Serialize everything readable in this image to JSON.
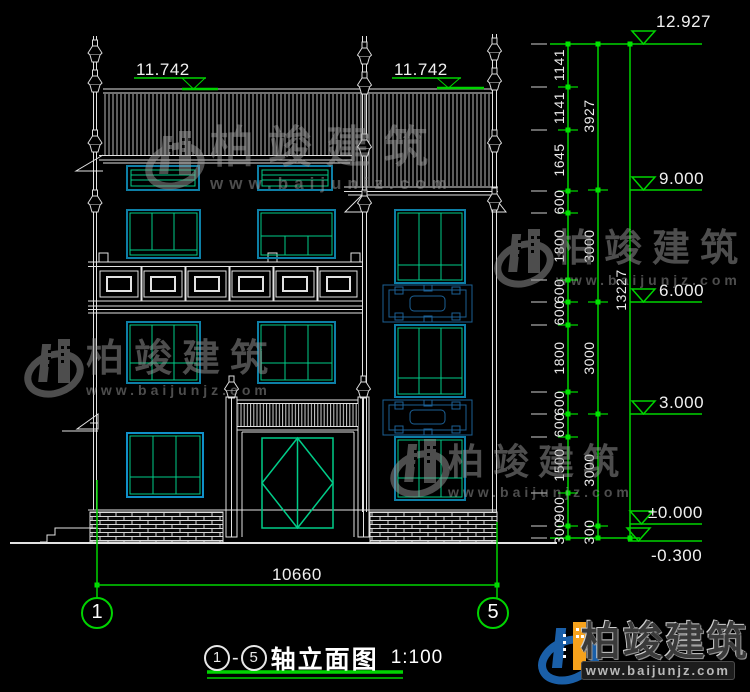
{
  "drawing_type": "elevation",
  "colors": {
    "background": "#000000",
    "linework_white": "#e2e2e2",
    "dimension_green": "#00d400",
    "window_frame_cyan": "#0d7fa6",
    "window_glass_green": "#00cc88",
    "panel_blue": "#1c6095",
    "logo_blue": "#1a5fa8",
    "logo_orange": "#f6a21c"
  },
  "annotations": {
    "eave_levels": [
      "11.742",
      "11.742"
    ],
    "levels": [
      "12.927",
      "9.000",
      "6.000",
      "3.000",
      "±0.000",
      "-0.300"
    ],
    "dim_chain_inner": [
      "1141",
      "1141",
      "1645",
      "600",
      "1800",
      "600",
      "600",
      "1800",
      "600",
      "600",
      "1500",
      "900",
      "300"
    ],
    "dim_chain_mid": [
      "3927",
      "3000",
      "3000",
      "3000",
      "300"
    ],
    "dim_chain_outer": [
      "13227"
    ],
    "width_dim": "10660",
    "axis_bubbles": [
      "1",
      "5"
    ]
  },
  "title": {
    "axis_from": "1",
    "dash": "-",
    "axis_to": "5",
    "text": "轴立面图",
    "scale": "1:100"
  },
  "watermark": {
    "brand": "柏竣建筑",
    "site": "www.baijunjz.com"
  }
}
